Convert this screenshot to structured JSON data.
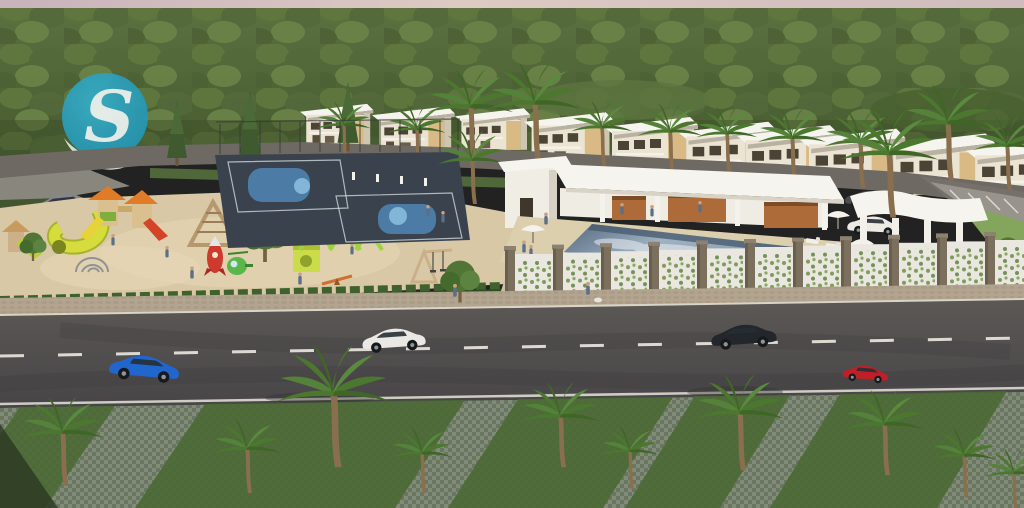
{
  "meta": {
    "kind": "architectural-aerial-rendering",
    "subject": "Residential community amenities: playground, basketball courts, clubhouse with pool, villas row, boulevard with landscaped median"
  },
  "logo": {
    "letter": "S",
    "bg_color": "#2aa1bd"
  },
  "palette": {
    "sky_pink": "#d7c3c1",
    "forest": "#52663a",
    "forest_dark": "#41542e",
    "sand": "#d9c8a5",
    "court": "#3a434d",
    "court_blue": "#4d80aa",
    "pool_light": "#9fb2c1",
    "pool_dark": "#5d7186",
    "deck": "#dbcfae",
    "roof_white": "#f6f4ee",
    "wood": "#ad6b39",
    "asphalt": "#53504e",
    "sidewalk": "#b2a48f",
    "median": "#7e8874",
    "grass": "#4a6934",
    "hedge": "#3e612e",
    "fence_panel": "#e9e7df",
    "pillar": "#7b6f5d",
    "lawn": "#84a55c",
    "logo_text": "#edf5f4"
  },
  "scene": {
    "areas": [
      "forest",
      "villas-row",
      "playground",
      "basketball-courts",
      "clubhouse",
      "swimming-pool",
      "pergola",
      "perimeter-fence",
      "sidewalk",
      "main-road",
      "landscaped-median"
    ],
    "vehicles": [
      {
        "name": "gray-suv-back-road",
        "color": "#84878b"
      },
      {
        "name": "blue-coupe",
        "color": "#2066cc"
      },
      {
        "name": "white-hatchback",
        "color": "#e9e8e4"
      },
      {
        "name": "black-sedan",
        "color": "#23262a"
      },
      {
        "name": "red-hatchback",
        "color": "#c01f27"
      },
      {
        "name": "parked-white-car",
        "color": "#eceae3"
      },
      {
        "name": "parked-dark-car",
        "color": "#4a4c4e"
      }
    ]
  }
}
